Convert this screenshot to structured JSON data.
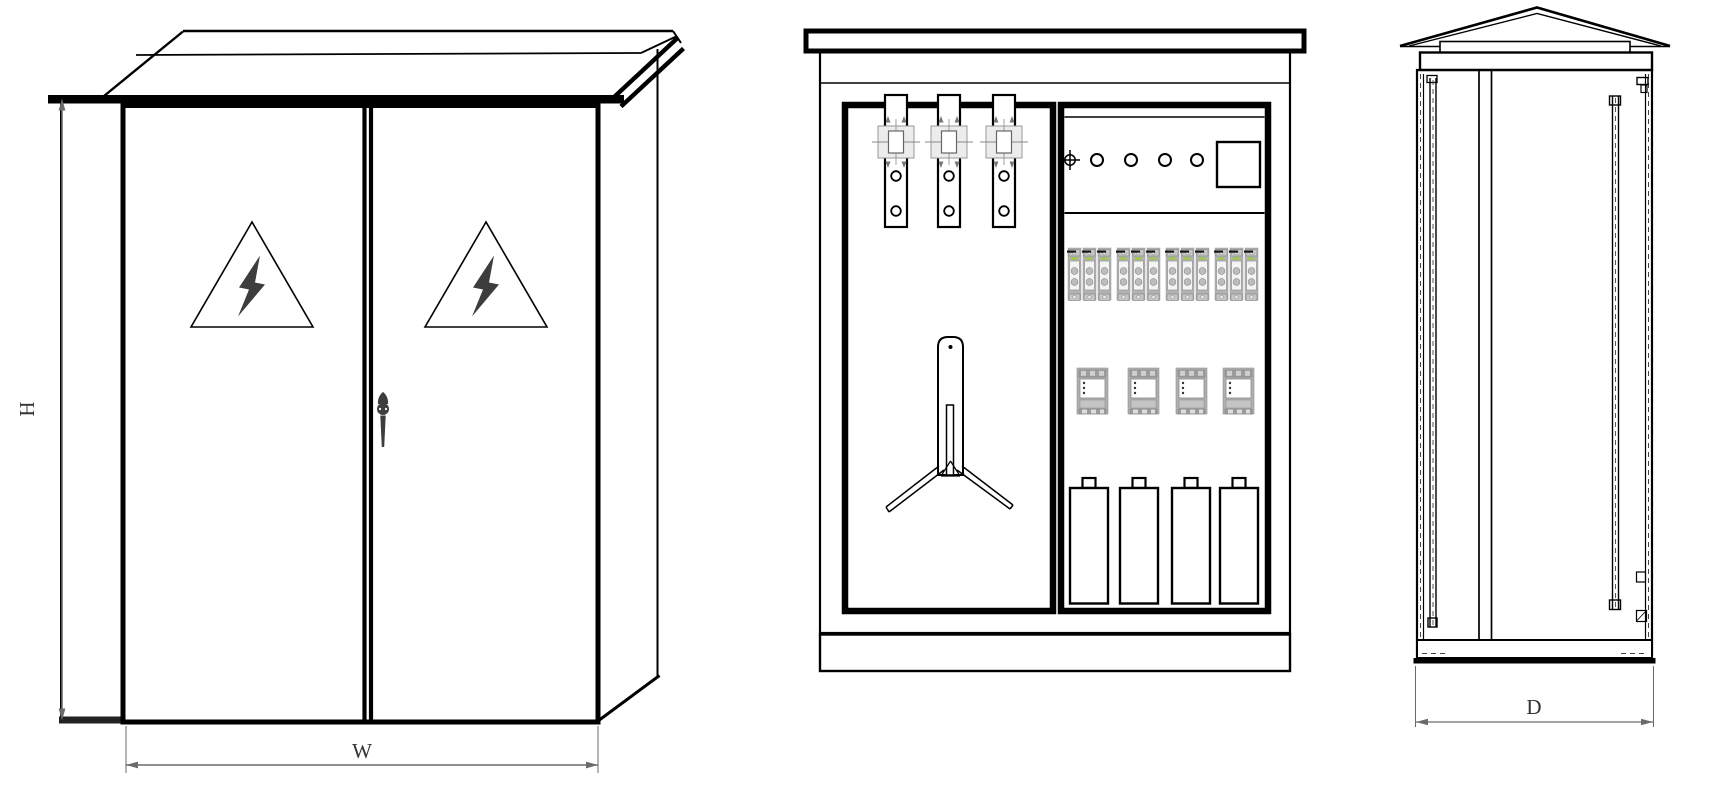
{
  "colors": {
    "line": "#000000",
    "dim": "#6a6a6a",
    "label": "#333333",
    "equip": "#b3b3b3",
    "indicator": "#9acd32",
    "background": "#ffffff"
  },
  "dimensions": {
    "height_label": "H",
    "width_label": "W",
    "depth_label": "D"
  },
  "left_view": {
    "warning_triangles": [
      {
        "x": 252,
        "y": 274.5
      },
      {
        "x": 486,
        "y": 274.5
      }
    ]
  },
  "middle_view": {
    "busbars": [
      {
        "x": 885
      },
      {
        "x": 938
      },
      {
        "x": 993
      }
    ],
    "indicator_lights": [
      {
        "x": 1097
      },
      {
        "x": 1131
      },
      {
        "x": 1165
      },
      {
        "x": 1197
      }
    ],
    "fuses": [
      {
        "x": 1068
      },
      {
        "x": 1083
      },
      {
        "x": 1098
      },
      {
        "x": 1117
      },
      {
        "x": 1132
      },
      {
        "x": 1147
      },
      {
        "x": 1166
      },
      {
        "x": 1181
      },
      {
        "x": 1196
      },
      {
        "x": 1215
      },
      {
        "x": 1230
      },
      {
        "x": 1245
      }
    ],
    "breakers": [
      {
        "x": 1077
      },
      {
        "x": 1128
      },
      {
        "x": 1176
      },
      {
        "x": 1223
      }
    ],
    "capacitors": [
      {
        "x": 1070
      },
      {
        "x": 1120
      },
      {
        "x": 1172
      },
      {
        "x": 1220
      }
    ]
  },
  "right_view": {}
}
